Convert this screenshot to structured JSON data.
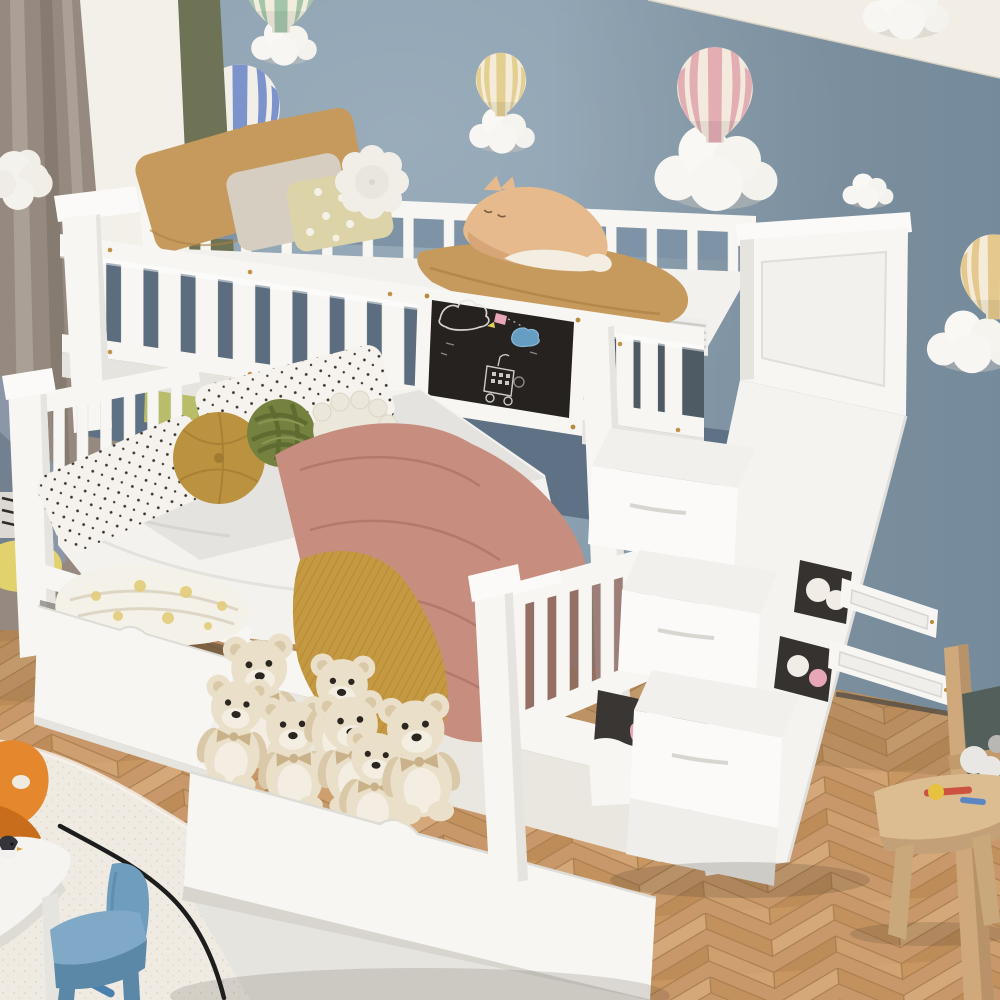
{
  "meta": {
    "title": "Children's bedroom with white twin-over-full bunk bed with storage staircase and under-bed drawers",
    "style": "product photograph, no visible text"
  },
  "palette": {
    "wall": "#8ca1b1",
    "wallshadow": "#61788b",
    "ceiling": "#f2eee6",
    "curtain": "#968a80",
    "curtainlight": "#aaa096",
    "whiteband": "#f3f0ea",
    "olive": "#6f7355",
    "greencurtain": "#b7bd68",
    "greendark": "#98a04d",
    "floorA": "#d2a473",
    "floorB": "#c2915e",
    "floorline": "#a97e4e",
    "rug": "#efebe2",
    "rugshade": "#ddd7cb",
    "bedwhite": "#f7f6f3",
    "bedlight": "#fbfaf8",
    "bedshade": "#e6e4df",
    "beddark": "#cfccc7",
    "chalk": "#262220",
    "chalkline": "#e9e7e1",
    "camel": "#c69a5d",
    "cameldark": "#ab8044",
    "beigepillow": "#d6cfc1",
    "pompillow": "#ddd3a9",
    "flowerpillow": "#f1eee8",
    "rose": "#c78d7f",
    "rosedark": "#ad7166",
    "mustard": "#c59941",
    "mustarddark": "#a98230",
    "roundpillow": "#bb9240",
    "knot": "#74813f",
    "sheepbody": "#ece7db",
    "sheepface": "#6a4732",
    "cattan": "#e6ba8c",
    "catwhite": "#f3eee1",
    "bear": "#eadfc9",
    "bearshade": "#d9c9a9",
    "bearface": "#2c2621",
    "bow": "#c9b289",
    "teepee": "#8b97a8",
    "teepeedark": "#72808f",
    "cushion": "#e2d26d",
    "orange": "#e5872d",
    "orangedark": "#c76d1b",
    "bluechair": "#6f9dbd",
    "bluechairlight": "#7fa9c6",
    "bluechairdark": "#5b88a7",
    "table": "#f6f4f0",
    "stool": "#dcbd92",
    "wood": "#cfa97b",
    "easelboard": "#525f5a",
    "cable": "#1d1d1d",
    "plushpink": "#e8a7b6"
  },
  "scene": {
    "room": {
      "wall": "muted blue-gray painted wall",
      "ceiling": "white ceiling wedge at top right",
      "floor": "light oak herringbone parquet",
      "left": "taupe curtain, white window band, olive-green curtain panel"
    },
    "wall_decor": {
      "balloons": [
        {
          "id": "blue",
          "x": 240,
          "y": 114,
          "scale": 0.95,
          "stripe": "#7d93cc",
          "base": "#f2efe8"
        },
        {
          "id": "mint",
          "x": 281,
          "y": -16,
          "scale": 0.9,
          "stripe": "#a3c6ab",
          "base": "#f1ecdc"
        },
        {
          "id": "yellow-left",
          "x": 501,
          "y": 84,
          "scale": 0.6,
          "stripe": "#e4cf92",
          "base": "#f4ecd8"
        },
        {
          "id": "pink",
          "x": 715,
          "y": 94,
          "scale": 0.9,
          "stripe": "#e2adb3",
          "base": "#f3e9dd"
        },
        {
          "id": "yellow-right",
          "x": 994,
          "y": 276,
          "scale": 0.8,
          "stripe": "#e5c88e",
          "base": "#f4ecd8"
        }
      ],
      "clouds": [
        {
          "x": 284,
          "y": 40,
          "scale": 0.8
        },
        {
          "x": 502,
          "y": 128,
          "scale": 0.8
        },
        {
          "x": 716,
          "y": 163,
          "scale": 1.5
        },
        {
          "x": 868,
          "y": 189,
          "scale": 0.62
        },
        {
          "x": 906,
          "y": 6,
          "scale": 1.05
        },
        {
          "x": 972,
          "y": 338,
          "scale": 1.1
        }
      ]
    },
    "bunk_bed": {
      "frame": "white wood, vertical slat guard rails, brass screws",
      "upper_bunk": {
        "pillows": [
          "camel",
          "camel",
          "beige textured",
          "pale pom-pom",
          "white flower"
        ],
        "plush": "tan and white cat lying on camel blanket",
        "sheets": "white with gray striped edge",
        "chalkboard": {
          "background": "black chalkboard panel on front rail",
          "drawings": [
            "cloud",
            "rocket with dotted trail",
            "blue cloud",
            "house on wheels",
            "chalk dashes"
          ]
        }
      },
      "lower_bunk": {
        "pillows": [
          "white black-dot",
          "white black-dot",
          "round mustard",
          "green knot",
          "sheep plush"
        ],
        "blankets": [
          "dusty-rose throw",
          "mustard knit throw"
        ]
      },
      "drawers": [
        {
          "position": "left",
          "contents": "folded white bedding with yellow pattern"
        },
        {
          "position": "right",
          "contents": "seven cream teddy bears with bows"
        }
      ],
      "staircase": {
        "steps": 3,
        "cubbies": [
          "white plush balls",
          "white and pink plush",
          "unicorn plush with pink blanket"
        ],
        "wall_rails": 2
      }
    },
    "bears": [
      {
        "x": 262,
        "y": 708,
        "s": 2.0,
        "r": -4,
        "layer": "drawer"
      },
      {
        "x": 233,
        "y": 744,
        "s": 1.85,
        "r": 6,
        "layer": "drawer"
      },
      {
        "x": 294,
        "y": 766,
        "s": 1.9,
        "r": -2,
        "layer": "drawer"
      },
      {
        "x": 340,
        "y": 722,
        "s": 1.85,
        "r": 3,
        "layer": "drawer"
      },
      {
        "x": 354,
        "y": 763,
        "s": 1.95,
        "r": -5,
        "layer": "drawer"
      },
      {
        "x": 374,
        "y": 794,
        "s": 1.8,
        "r": 4,
        "layer": "drawer"
      },
      {
        "x": 420,
        "y": 770,
        "s": 2.05,
        "r": -6,
        "layer": "front"
      }
    ],
    "play_area": {
      "rug": "white shaggy irregular rug",
      "table": "white kids table with small penguin toy",
      "chairs": [
        "orange plastic kids chair",
        "blue plastic kids chair"
      ],
      "floor_items": [
        "black cable squiggle",
        "blue pen"
      ]
    },
    "left_corner": {
      "tent": "blue-gray play teepee with yellow cushion"
    },
    "right_corner": {
      "easel": "wooden easel with dark board and white cloth",
      "stool": "wooden stool with toy tools (red, yellow, blue)"
    }
  }
}
